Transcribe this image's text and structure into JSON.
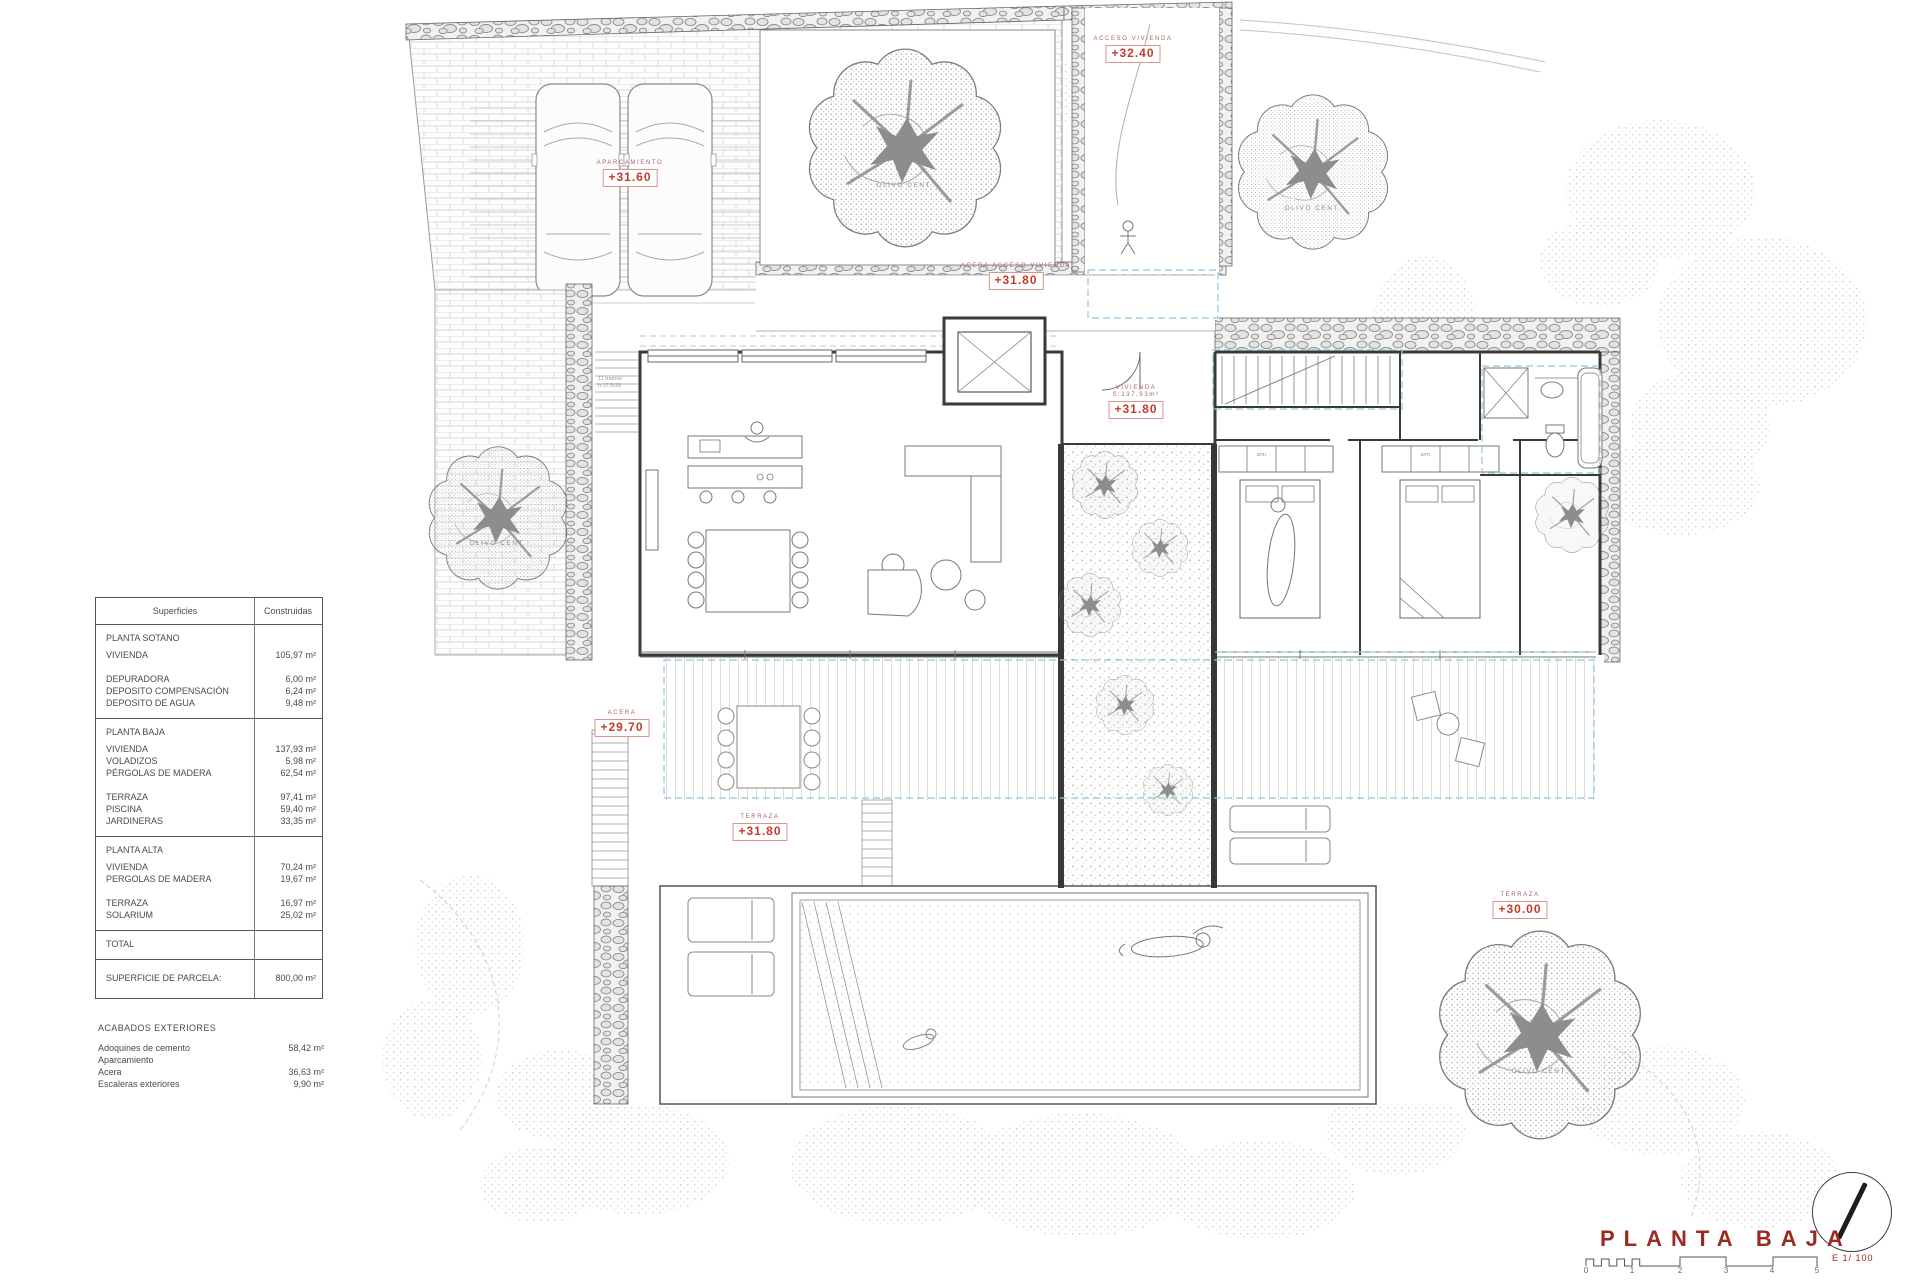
{
  "colors": {
    "accent_red": "#c23b2e",
    "title_red": "#9b2a20",
    "pergola_dashed_blue": "#8fc8db"
  },
  "areas_table": {
    "header_col1": "Superficies",
    "header_col2": "Construidas",
    "sotano_heading": "PLANTA SOTANO",
    "sotano_vivienda": "VIVIENDA",
    "sotano_vivienda_v": "105,97 m²",
    "depuradora": "DEPURADORA",
    "depuradora_v": "6,00 m²",
    "deposito_comp": "DEPOSITO COMPENSACIÓN",
    "deposito_comp_v": "6,24 m²",
    "deposito_agua": "DEPOSITO DE AGUA",
    "deposito_agua_v": "9,48 m²",
    "baja_heading": "PLANTA BAJA",
    "baja_vivienda": "VIVIENDA",
    "baja_vivienda_v": "137,93 m²",
    "voladizos": "VOLADIZOS",
    "voladizos_v": "5,98 m²",
    "pergolas": "PÉRGOLAS DE MADERA",
    "pergolas_v": "62,54 m²",
    "terraza": "TERRAZA",
    "terraza_v": "97,41 m²",
    "piscina": "PISCINA",
    "piscina_v": "59,40 m²",
    "jardineras": "JARDINERAS",
    "jardineras_v": "33,35 m²",
    "alta_heading": "PLANTA ALTA",
    "alta_vivienda": "VIVIENDA",
    "alta_vivienda_v": "70,24 m²",
    "alta_pergolas": "PERGOLAS DE MADERA",
    "alta_pergolas_v": "19,67 m²",
    "alta_terraza": "TERRAZA",
    "alta_terraza_v": "16,97 m²",
    "solarium": "SOLARIUM",
    "solarium_v": "25,02 m²",
    "total": "TOTAL",
    "parcela": "SUPERFICIE DE PARCELA:",
    "parcela_v": "800,00 m²"
  },
  "acabados": {
    "heading": "ACABADOS EXTERIORES",
    "r1": "Adoquines de cemento Aparcamiento",
    "r1_v": "58,42 m²",
    "r2": "Acera",
    "r2_v": "36,63 m²",
    "r3": "Escaleras exteriores",
    "r3_v": "9,90 m²"
  },
  "levels": {
    "aparcamiento": {
      "area": "APARCAMIENTO",
      "value": "+31.60"
    },
    "acceso_vivienda": {
      "area": "ACCESO VIVIENDA",
      "value": "+32.40"
    },
    "acera_acceso": {
      "area": "ACERA ACCESO VIVIENDA",
      "value": "+31.80"
    },
    "vivienda": {
      "area": "VIVIENDA",
      "detail": "S:137,93m²",
      "value": "+31.80"
    },
    "acera": {
      "area": "ACERA",
      "value": "+29.70"
    },
    "terraza": {
      "area": "TERRAZA",
      "value": "+31.80"
    },
    "terraza_piscina": {
      "area": "TERRAZA",
      "value": "+30.00"
    }
  },
  "annotations": {
    "olivo": "OLIVO CENT.",
    "closet": "arm.",
    "stair_note_1": "11 tramos",
    "stair_note_2": "h:17,5/28"
  },
  "title_block": {
    "title": "PLANTA BAJA",
    "scale_text": "E 1/ 100",
    "scale_ticks": [
      "0",
      "1",
      "2",
      "3",
      "4",
      "5"
    ]
  }
}
